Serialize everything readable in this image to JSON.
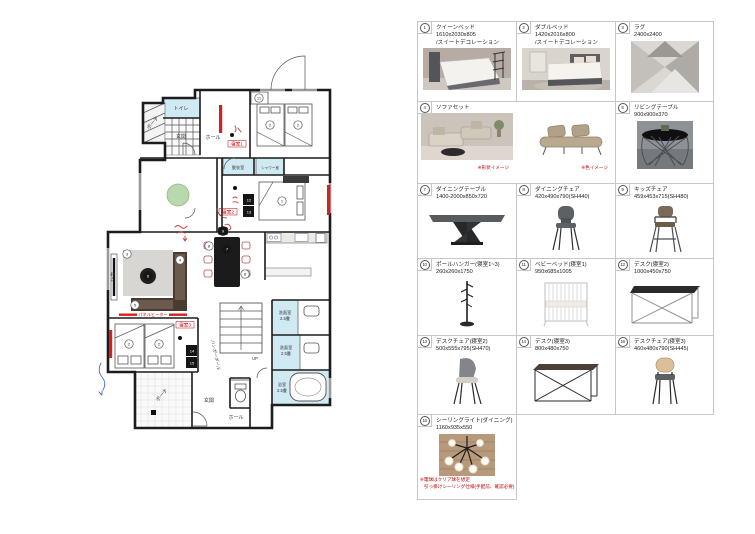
{
  "colors": {
    "annotation_red": "#c00000",
    "wall_black": "#1c1c1c",
    "room_blue": "#cfeaf2",
    "tatami_green": "#b9d8ae",
    "rug_gray": "#d8d6d2",
    "sofa_brown": "#4a3b31",
    "heater_red": "#d42020",
    "grid_border": "#c7c7c7"
  },
  "catalog": {
    "items": [
      {
        "num": "1",
        "name": "クイーンベッド",
        "dims": "1610x2030x805",
        "note": "/スイートデコレーション"
      },
      {
        "num": "2",
        "name": "ダブルベッド",
        "dims": "1420x2016x800",
        "note": "/スイートデコレーション"
      },
      {
        "num": "3",
        "name": "ラグ",
        "dims": "2400x2400"
      },
      {
        "num": "4",
        "name": "ソファセット",
        "cap1": "※形状イメージ",
        "cap2": "※色イメージ"
      },
      {
        "num": "6",
        "name": "リビングテーブル",
        "dims": "900x900x370"
      },
      {
        "num": "7",
        "name": "ダイニングテーブル",
        "dims": "1400-2000x850x720"
      },
      {
        "num": "8",
        "name": "ダイニングチェア",
        "dims": "420x490x790(SH440)"
      },
      {
        "num": "9",
        "name": "キッズチェア",
        "dims": "459x453x715(SH480)"
      },
      {
        "num": "10",
        "name": "ポールハンガー(寝室1~3)",
        "dims": "260x260x1750"
      },
      {
        "num": "11",
        "name": "ベビーベッド(寝室1)",
        "dims": "950x685x1005"
      },
      {
        "num": "12",
        "name": "デスク(寝室2)",
        "dims": "1000x450x750"
      },
      {
        "num": "13",
        "name": "デスクチェア(寝室2)",
        "dims": "500x555x795(SH470)"
      },
      {
        "num": "14",
        "name": "デスク(寝室3)",
        "dims": "800x480x750"
      },
      {
        "num": "15",
        "name": "デスクチェア(寝室3)",
        "dims": "460x480x790(SH445)"
      },
      {
        "num": "16",
        "name": "シーリングライト(ダイニング)",
        "dims": "1160x935x550",
        "note1": "※電球はクリア球を想定",
        "note2": "引っ掛けシーリング仕様(手配前、確認必要)"
      }
    ]
  },
  "floorplan": {
    "labels": {
      "toilet": "トイレ",
      "porch_top": "ポーチ",
      "entrance_top": "玄関",
      "hall_top": "ホール",
      "bedroom1": "寝室1",
      "dressing": "脱衣室",
      "shower": "シャワー室",
      "bedroom2": "寝室2",
      "tv": "TV台",
      "panel_heater": "パネルヒーター",
      "bedroom3": "寝室3",
      "hanger_pole": "ハンガーポール",
      "washroom_a": "洗面室",
      "washroom_a_size": "2.5畳",
      "washroom_b": "洗面室",
      "washroom_b_size": "2.5畳",
      "bath": "浴室",
      "bath_size": "2.5畳",
      "up": "UP",
      "porch_bottom": "ポーチ",
      "entrance_bottom": "玄関",
      "hall_bottom": "ホール"
    },
    "markers": [
      {
        "x": 235,
        "y": 77,
        "t": "2"
      },
      {
        "x": 263,
        "y": 77,
        "t": "2"
      },
      {
        "x": 224,
        "y": 50,
        "t": "11"
      },
      {
        "x": 247,
        "y": 153,
        "t": "1"
      },
      {
        "x": 214,
        "y": 152,
        "t": "12",
        "s": "dark"
      },
      {
        "x": 214,
        "y": 164,
        "t": "13",
        "s": "dark"
      },
      {
        "x": 92,
        "y": 206,
        "t": "3"
      },
      {
        "x": 145,
        "y": 212,
        "t": "4"
      },
      {
        "x": 100,
        "y": 257,
        "t": "5"
      },
      {
        "x": 113,
        "y": 228,
        "t": "6",
        "s": "dark"
      },
      {
        "x": 192,
        "y": 201,
        "t": "7",
        "s": "dark"
      },
      {
        "x": 174,
        "y": 198,
        "t": "8"
      },
      {
        "x": 210,
        "y": 226,
        "t": "8"
      },
      {
        "x": 188,
        "y": 183,
        "t": "9",
        "s": "dark"
      },
      {
        "x": 94,
        "y": 296,
        "t": "2"
      },
      {
        "x": 124,
        "y": 296,
        "t": "2"
      },
      {
        "x": 157,
        "y": 303,
        "t": "14",
        "s": "dark"
      },
      {
        "x": 157,
        "y": 315,
        "t": "15",
        "s": "dark"
      }
    ]
  }
}
